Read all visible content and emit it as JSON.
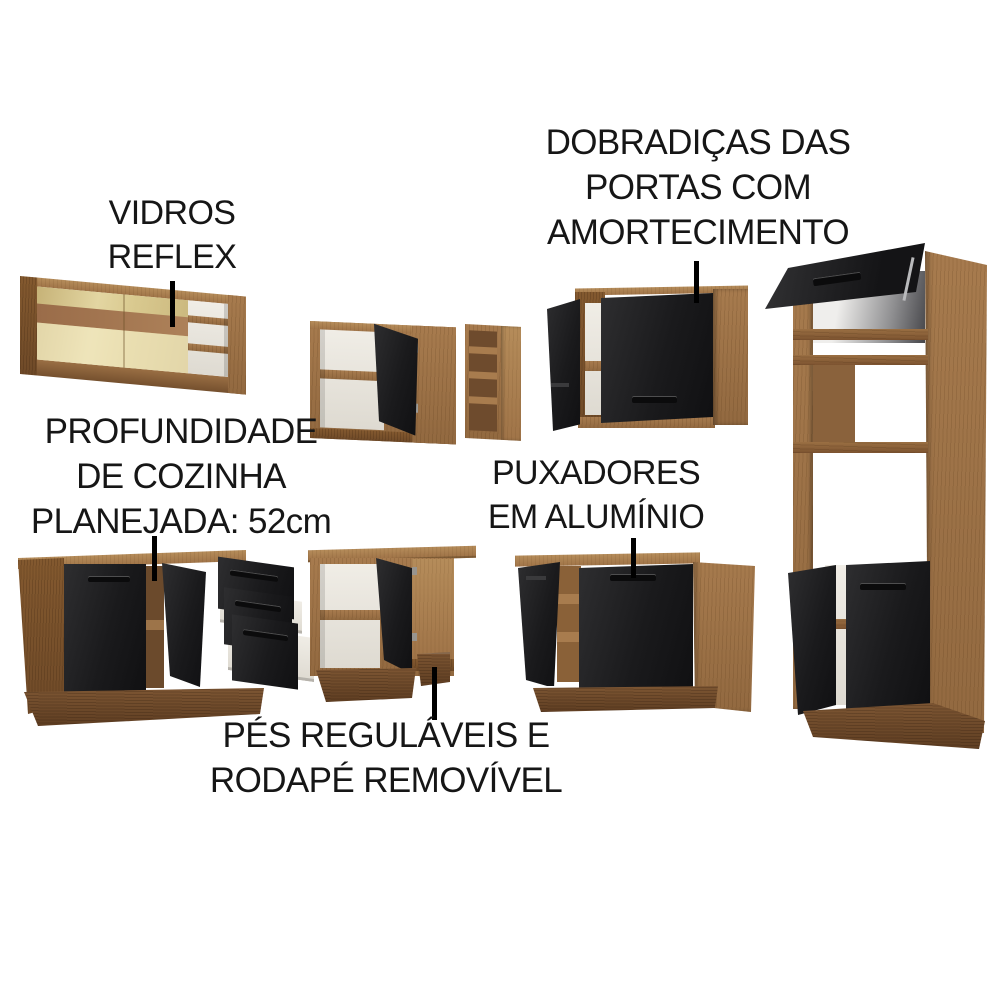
{
  "page": {
    "background": "#ffffff",
    "kind": "kitchen-cabinet-feature-collage"
  },
  "annotations": {
    "vidros": {
      "line1": "VIDROS",
      "line2": "REFLEX"
    },
    "dobradicas": {
      "line1": "DOBRADIÇAS DAS",
      "line2": "PORTAS COM",
      "line3": "AMORTECIMENTO"
    },
    "profundidade": {
      "line1": "PROFUNDIDADE",
      "line2": "DE COZINHA",
      "line3": "PLANEJADA: 52cm"
    },
    "puxadores": {
      "line1": "PUXADORES",
      "line2": "EM ALUMÍNIO"
    },
    "pes": {
      "line1": "PÉS REGULÁVEIS E",
      "line2": "RODAPÉ REMOVÍVEL"
    }
  },
  "colors": {
    "text": "#161616",
    "leader_line": "#000000",
    "wood_front": "#9b7347",
    "wood_light": "#b08a58",
    "wood_side": "#7a5431",
    "plinth": "#6b4729",
    "door_black": "#1d1d1f",
    "interior_white": "#eae7e0",
    "glass_amber": "#d8c893",
    "glass_shelf_band": "#96684a",
    "aluminium_handle": "#0b0b0c"
  },
  "furniture": [
    {
      "id": "glass-wall-cabinet",
      "feature": "vidros reflex"
    },
    {
      "id": "corner-wall-cabinet",
      "feature": ""
    },
    {
      "id": "open-shelf-wall-unit",
      "feature": ""
    },
    {
      "id": "two-door-wall-cabinet",
      "feature": "dobradiças com amortecimento"
    },
    {
      "id": "tall-oven-tower-cabinet",
      "feature": ""
    },
    {
      "id": "drawer-base-cabinet",
      "feature": "profundidade 52cm"
    },
    {
      "id": "corner-base-cabinet",
      "feature": "pés reguláveis e rodapé removível"
    },
    {
      "id": "two-door-base-cabinet",
      "feature": "puxadores em alumínio"
    }
  ]
}
